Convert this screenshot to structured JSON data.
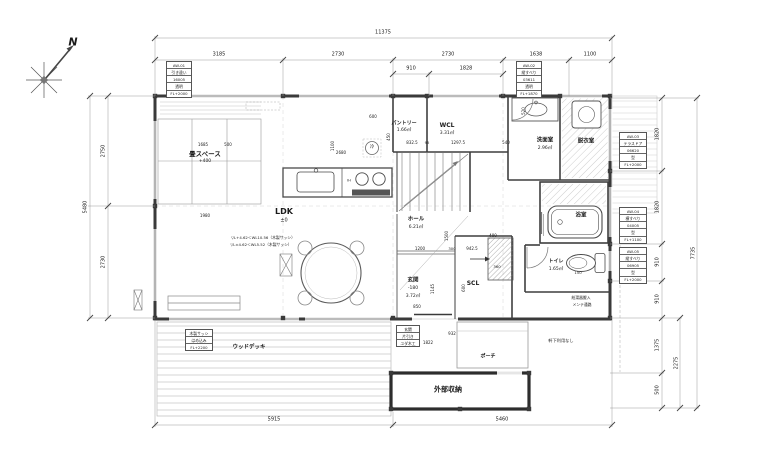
{
  "page": {
    "width": 768,
    "height": 465,
    "background": "#ffffff"
  },
  "colors": {
    "wall": "#3a3a3a",
    "thin_line": "#777777",
    "hatch": "#b8b8b8",
    "deck": "#c9c9c9",
    "text": "#1b1b1b"
  },
  "compass": {
    "north_label": "N"
  },
  "annotations": [
    {
      "name": "compass-north-label",
      "text": "N",
      "x": 73,
      "y": 42,
      "size": 11,
      "bold": true,
      "italic": true
    },
    {
      "name": "dim-label",
      "text": "11375",
      "x": 383,
      "y": 33,
      "size": 5
    },
    {
      "name": "dim-label",
      "text": "3185",
      "x": 219,
      "y": 55,
      "size": 5
    },
    {
      "name": "dim-label",
      "text": "2730",
      "x": 338,
      "y": 55,
      "size": 5
    },
    {
      "name": "dim-label",
      "text": "2730",
      "x": 448,
      "y": 55,
      "size": 5
    },
    {
      "name": "dim-label",
      "text": "1638",
      "x": 536,
      "y": 55,
      "size": 5
    },
    {
      "name": "dim-label",
      "text": "1100",
      "x": 590,
      "y": 55,
      "size": 5
    },
    {
      "name": "dim-label",
      "text": "910",
      "x": 411,
      "y": 69,
      "size": 5
    },
    {
      "name": "dim-label",
      "text": "1828",
      "x": 466,
      "y": 69,
      "size": 5
    },
    {
      "name": "dim-label",
      "text": "2750",
      "x": 104,
      "y": 151,
      "size": 5,
      "rot": -90
    },
    {
      "name": "dim-label",
      "text": "2730",
      "x": 104,
      "y": 262,
      "size": 5,
      "rot": -90
    },
    {
      "name": "dim-label",
      "text": "5480",
      "x": 86,
      "y": 207,
      "size": 5,
      "rot": -90
    },
    {
      "name": "dim-label",
      "text": "1820",
      "x": 658,
      "y": 134,
      "size": 5,
      "rot": -90
    },
    {
      "name": "dim-label",
      "text": "1820",
      "x": 658,
      "y": 207,
      "size": 5,
      "rot": -90
    },
    {
      "name": "dim-label",
      "text": "910",
      "x": 658,
      "y": 262,
      "size": 5,
      "rot": -90
    },
    {
      "name": "dim-label",
      "text": "910",
      "x": 658,
      "y": 299,
      "size": 5,
      "rot": -90
    },
    {
      "name": "dim-label",
      "text": "1375",
      "x": 658,
      "y": 345,
      "size": 5,
      "rot": -90
    },
    {
      "name": "dim-label",
      "text": "500",
      "x": 658,
      "y": 390,
      "size": 5,
      "rot": -90
    },
    {
      "name": "dim-label",
      "text": "2275",
      "x": 677,
      "y": 363,
      "size": 5,
      "rot": -90
    },
    {
      "name": "dim-label",
      "text": "7735",
      "x": 694,
      "y": 253,
      "size": 5,
      "rot": -90
    },
    {
      "name": "dim-label",
      "text": "5915",
      "x": 274,
      "y": 420,
      "size": 5
    },
    {
      "name": "dim-label",
      "text": "5460",
      "x": 502,
      "y": 420,
      "size": 5
    },
    {
      "name": "room-label-tatami",
      "text": "畳スペース",
      "x": 205,
      "y": 154,
      "size": 6.5,
      "bold": true
    },
    {
      "name": "room-sub-tatami",
      "text": "+400",
      "x": 205,
      "y": 162,
      "size": 4.5
    },
    {
      "name": "room-label-ldk",
      "text": "LDK",
      "x": 284,
      "y": 212,
      "size": 8,
      "bold": true
    },
    {
      "name": "room-sub-ldk",
      "text": "±0",
      "x": 284,
      "y": 221,
      "size": 5
    },
    {
      "name": "room-label-pantry",
      "text": "パントリー",
      "x": 404,
      "y": 124,
      "size": 5,
      "bold": true
    },
    {
      "name": "room-sub-pantry",
      "text": "1.66㎡",
      "x": 404,
      "y": 131,
      "size": 4.5
    },
    {
      "name": "room-label-wcl",
      "text": "WCL",
      "x": 447,
      "y": 126,
      "size": 6,
      "bold": true
    },
    {
      "name": "room-sub-wcl",
      "text": "3.31㎡",
      "x": 447,
      "y": 134,
      "size": 4.5
    },
    {
      "name": "room-label-senmen",
      "text": "洗面室",
      "x": 545,
      "y": 141,
      "size": 5.5,
      "bold": true
    },
    {
      "name": "room-sub-senmen",
      "text": "2.96㎡",
      "x": 545,
      "y": 149,
      "size": 4.5
    },
    {
      "name": "room-label-datsui",
      "text": "脱衣室",
      "x": 586,
      "y": 142,
      "size": 5.5,
      "bold": true
    },
    {
      "name": "room-label-bath",
      "text": "浴室",
      "x": 581,
      "y": 216,
      "size": 5.5,
      "bold": true
    },
    {
      "name": "room-label-toilet",
      "text": "トイレ",
      "x": 556,
      "y": 262,
      "size": 5,
      "bold": true
    },
    {
      "name": "room-sub-toilet",
      "text": "1.65㎡",
      "x": 556,
      "y": 270,
      "size": 4.5
    },
    {
      "name": "room-label-hall",
      "text": "ホール",
      "x": 416,
      "y": 220,
      "size": 5.5,
      "bold": true
    },
    {
      "name": "room-sub-hall",
      "text": "6.21㎡",
      "x": 416,
      "y": 228,
      "size": 4.5
    },
    {
      "name": "room-label-genkan",
      "text": "玄関",
      "x": 413,
      "y": 281,
      "size": 5.5,
      "bold": true
    },
    {
      "name": "room-sub-genkan-level",
      "text": "-180",
      "x": 413,
      "y": 289,
      "size": 4.5
    },
    {
      "name": "room-sub-genkan-area",
      "text": "3.72㎡",
      "x": 413,
      "y": 297,
      "size": 4.5
    },
    {
      "name": "room-label-scl",
      "text": "SCL",
      "x": 473,
      "y": 284,
      "size": 6,
      "bold": true
    },
    {
      "name": "room-label-storage",
      "text": "外部収納",
      "x": 448,
      "y": 390,
      "size": 7,
      "bold": true
    },
    {
      "name": "room-label-porch",
      "text": "ポーチ",
      "x": 488,
      "y": 357,
      "size": 5,
      "bold": true
    },
    {
      "name": "room-label-deck",
      "text": "ウッドデッキ",
      "x": 249,
      "y": 348,
      "size": 5.5,
      "bold": true
    },
    {
      "name": "fixture-label-fridge",
      "text": "冷",
      "x": 372,
      "y": 148,
      "size": 4.5
    },
    {
      "name": "fixture-label-ih",
      "text": "IH",
      "x": 349,
      "y": 181,
      "size": 3.5
    },
    {
      "name": "note-sash-1",
      "text": "▽L+4.62＜WL10.56（木製サッシ）",
      "x": 263,
      "y": 238,
      "size": 3.8
    },
    {
      "name": "note-sash-2",
      "text": "▽L±4.62＜WL5.52（木製サッシ）",
      "x": 261,
      "y": 245,
      "size": 3.8
    },
    {
      "name": "note-boiler-1",
      "text": "給湯器搬入",
      "x": 581,
      "y": 298,
      "size": 3.8
    },
    {
      "name": "note-boiler-2",
      "text": "メンテ通路",
      "x": 582,
      "y": 305,
      "size": 3.8
    },
    {
      "name": "note-eaves",
      "text": "軒下利用なし",
      "x": 561,
      "y": 341,
      "size": 4.2
    },
    {
      "name": "dim-label",
      "text": "1685",
      "x": 203,
      "y": 145,
      "size": 4
    },
    {
      "name": "dim-label",
      "text": "500",
      "x": 228,
      "y": 145,
      "size": 4
    },
    {
      "name": "dim-label",
      "text": "1980",
      "x": 205,
      "y": 216,
      "size": 4
    },
    {
      "name": "dim-label",
      "text": "600",
      "x": 373,
      "y": 117,
      "size": 4
    },
    {
      "name": "dim-label",
      "text": "450",
      "x": 389,
      "y": 137,
      "size": 4,
      "rot": -90
    },
    {
      "name": "dim-label",
      "text": "1100",
      "x": 333,
      "y": 146,
      "size": 4,
      "rot": -90
    },
    {
      "name": "dim-label",
      "text": "2680",
      "x": 341,
      "y": 153,
      "size": 4
    },
    {
      "name": "dim-label",
      "text": "832.5",
      "x": 412,
      "y": 143,
      "size": 4
    },
    {
      "name": "dim-label",
      "text": "95",
      "x": 427,
      "y": 143,
      "size": 3.8
    },
    {
      "name": "dim-label",
      "text": "1297.5",
      "x": 458,
      "y": 143,
      "size": 4
    },
    {
      "name": "dim-label",
      "text": "540",
      "x": 506,
      "y": 143,
      "size": 4
    },
    {
      "name": "dim-label",
      "text": "520",
      "x": 524,
      "y": 111,
      "size": 4,
      "rot": -90
    },
    {
      "name": "dim-label",
      "text": "1500",
      "x": 447,
      "y": 236,
      "size": 4,
      "rot": -90
    },
    {
      "name": "dim-label",
      "text": "1200",
      "x": 420,
      "y": 249,
      "size": 4
    },
    {
      "name": "dim-label",
      "text": "300",
      "x": 452,
      "y": 249,
      "size": 3.8
    },
    {
      "name": "dim-label",
      "text": "942.5",
      "x": 472,
      "y": 249,
      "size": 4
    },
    {
      "name": "dim-label",
      "text": "400",
      "x": 493,
      "y": 236,
      "size": 4
    },
    {
      "name": "dim-label",
      "text": "1145",
      "x": 433,
      "y": 289,
      "size": 4,
      "rot": -90
    },
    {
      "name": "dim-label",
      "text": "600",
      "x": 464,
      "y": 288,
      "size": 4,
      "rot": -90
    },
    {
      "name": "dim-label",
      "text": "850",
      "x": 417,
      "y": 307,
      "size": 4
    },
    {
      "name": "dim-label",
      "text": "360",
      "x": 497,
      "y": 267,
      "size": 3.8
    },
    {
      "name": "dim-label",
      "text": "150",
      "x": 578,
      "y": 273,
      "size": 3.8
    },
    {
      "name": "dim-label",
      "text": "932",
      "x": 452,
      "y": 334,
      "size": 4
    },
    {
      "name": "dim-label",
      "text": "1822",
      "x": 428,
      "y": 343,
      "size": 4
    }
  ],
  "spec_boxes": [
    {
      "name": "window-spec-aw01",
      "x": 166,
      "y": 61,
      "w": 26,
      "rows": [
        "AW-01",
        "引き違い",
        "16005",
        "透明",
        "FL+2000"
      ]
    },
    {
      "name": "window-spec-aw02",
      "x": 516,
      "y": 61,
      "w": 26,
      "rows": [
        "AW-02",
        "縦すべり",
        "03611",
        "透明",
        "FL+1870"
      ]
    },
    {
      "name": "window-spec-aw03",
      "x": 619,
      "y": 132,
      "w": 28,
      "rows": [
        "AW-03",
        "テラスドア",
        "06620",
        "型",
        "FL+2000"
      ]
    },
    {
      "name": "window-spec-aw04",
      "x": 619,
      "y": 207,
      "w": 28,
      "rows": [
        "AW-04",
        "横すべり",
        "04005",
        "型",
        "FL+1100"
      ]
    },
    {
      "name": "window-spec-aw05",
      "x": 619,
      "y": 247,
      "w": 28,
      "rows": [
        "AW-05",
        "縦すべり",
        "06905",
        "型",
        "FL+2000"
      ]
    },
    {
      "name": "window-spec-wood-sash",
      "x": 185,
      "y": 329,
      "w": 28,
      "rows": [
        "木製サッシ",
        "はめ込み",
        "FL+2200"
      ]
    },
    {
      "name": "door-spec-entrance",
      "x": 396,
      "y": 325,
      "w": 24,
      "rows": [
        "玄関",
        "片引き",
        "ユダ木工"
      ]
    }
  ]
}
